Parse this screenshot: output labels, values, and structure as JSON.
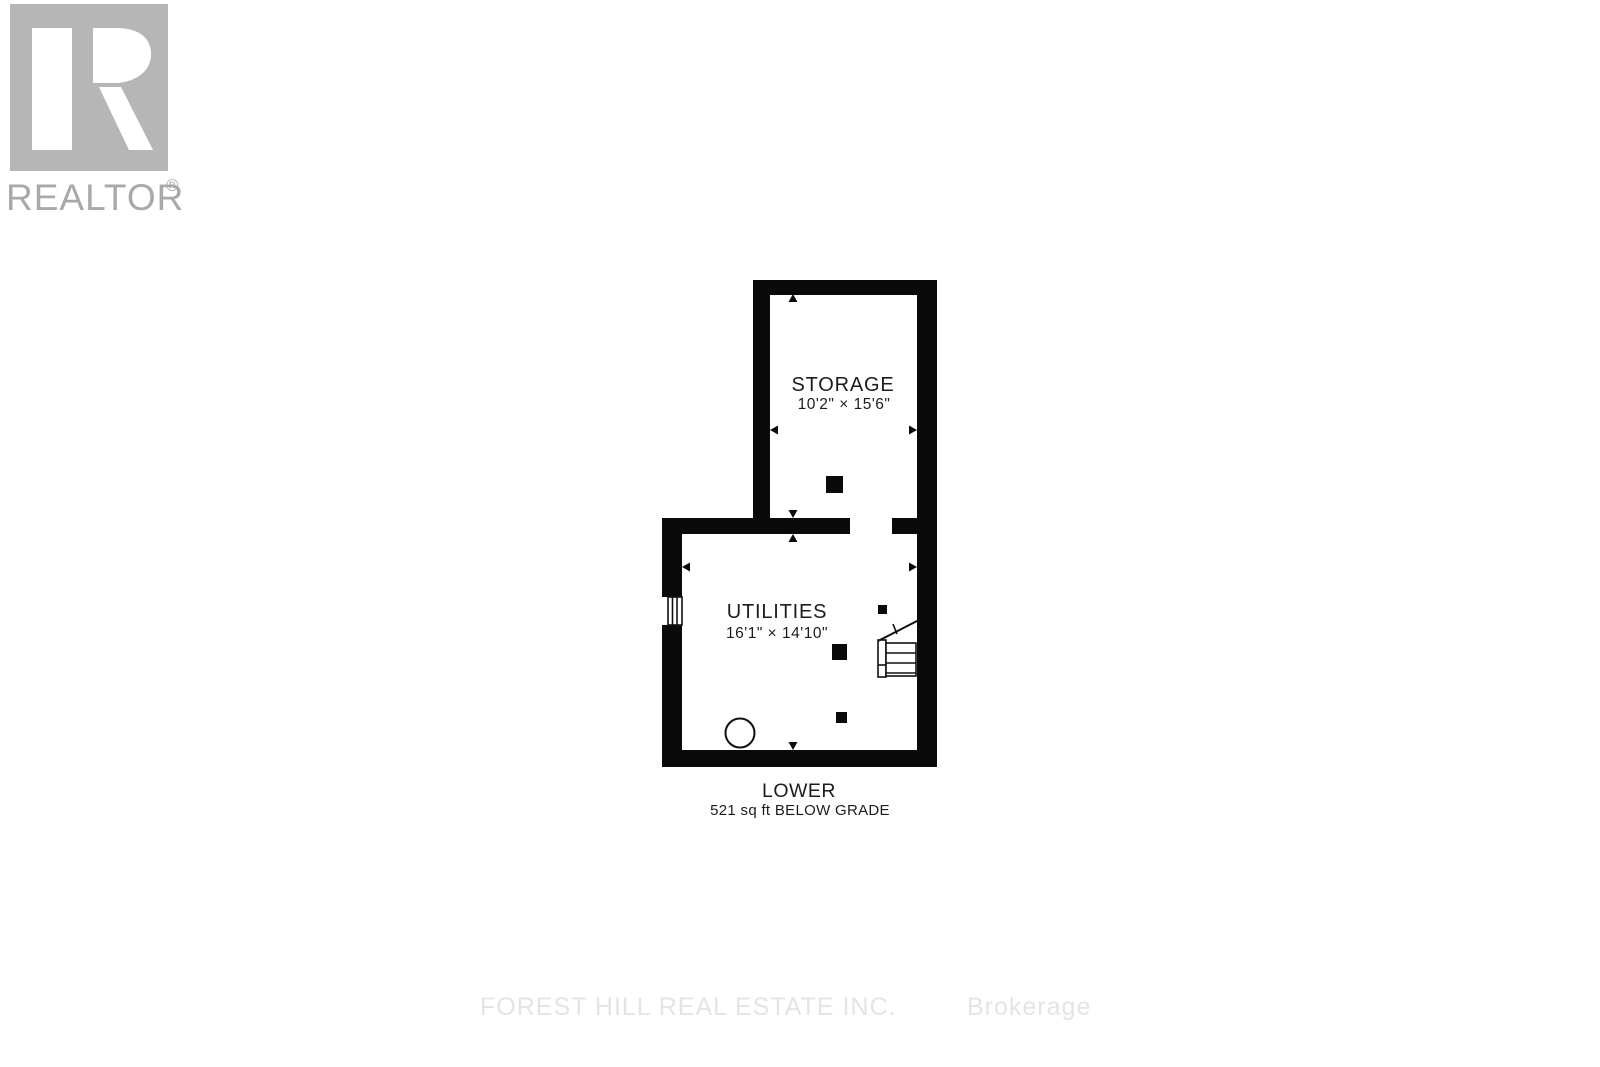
{
  "logo": {
    "wordmark": "REALTOR",
    "registered_mark": "®"
  },
  "floor_plan": {
    "rooms": [
      {
        "name": "STORAGE",
        "dimensions": "10'2\" × 15'6\""
      },
      {
        "name": "UTILITIES",
        "dimensions": "16'1\" × 14'10\""
      }
    ],
    "title": {
      "label": "LOWER",
      "area": "521 sq ft BELOW GRADE"
    },
    "symbols": [
      "stairs",
      "window",
      "support-posts",
      "tank-circle",
      "dimension-arrows"
    ]
  },
  "watermark": {
    "company": "FOREST HILL REAL ESTATE INC.",
    "suffix": "Brokerage"
  },
  "colors": {
    "wall": "#0a0a0a",
    "plan_text": "#1c1c1c",
    "logo_square": "#b6b6b6",
    "logo_text": "#a9a9a9",
    "watermark": "#e4e4e4",
    "background": "#ffffff"
  }
}
